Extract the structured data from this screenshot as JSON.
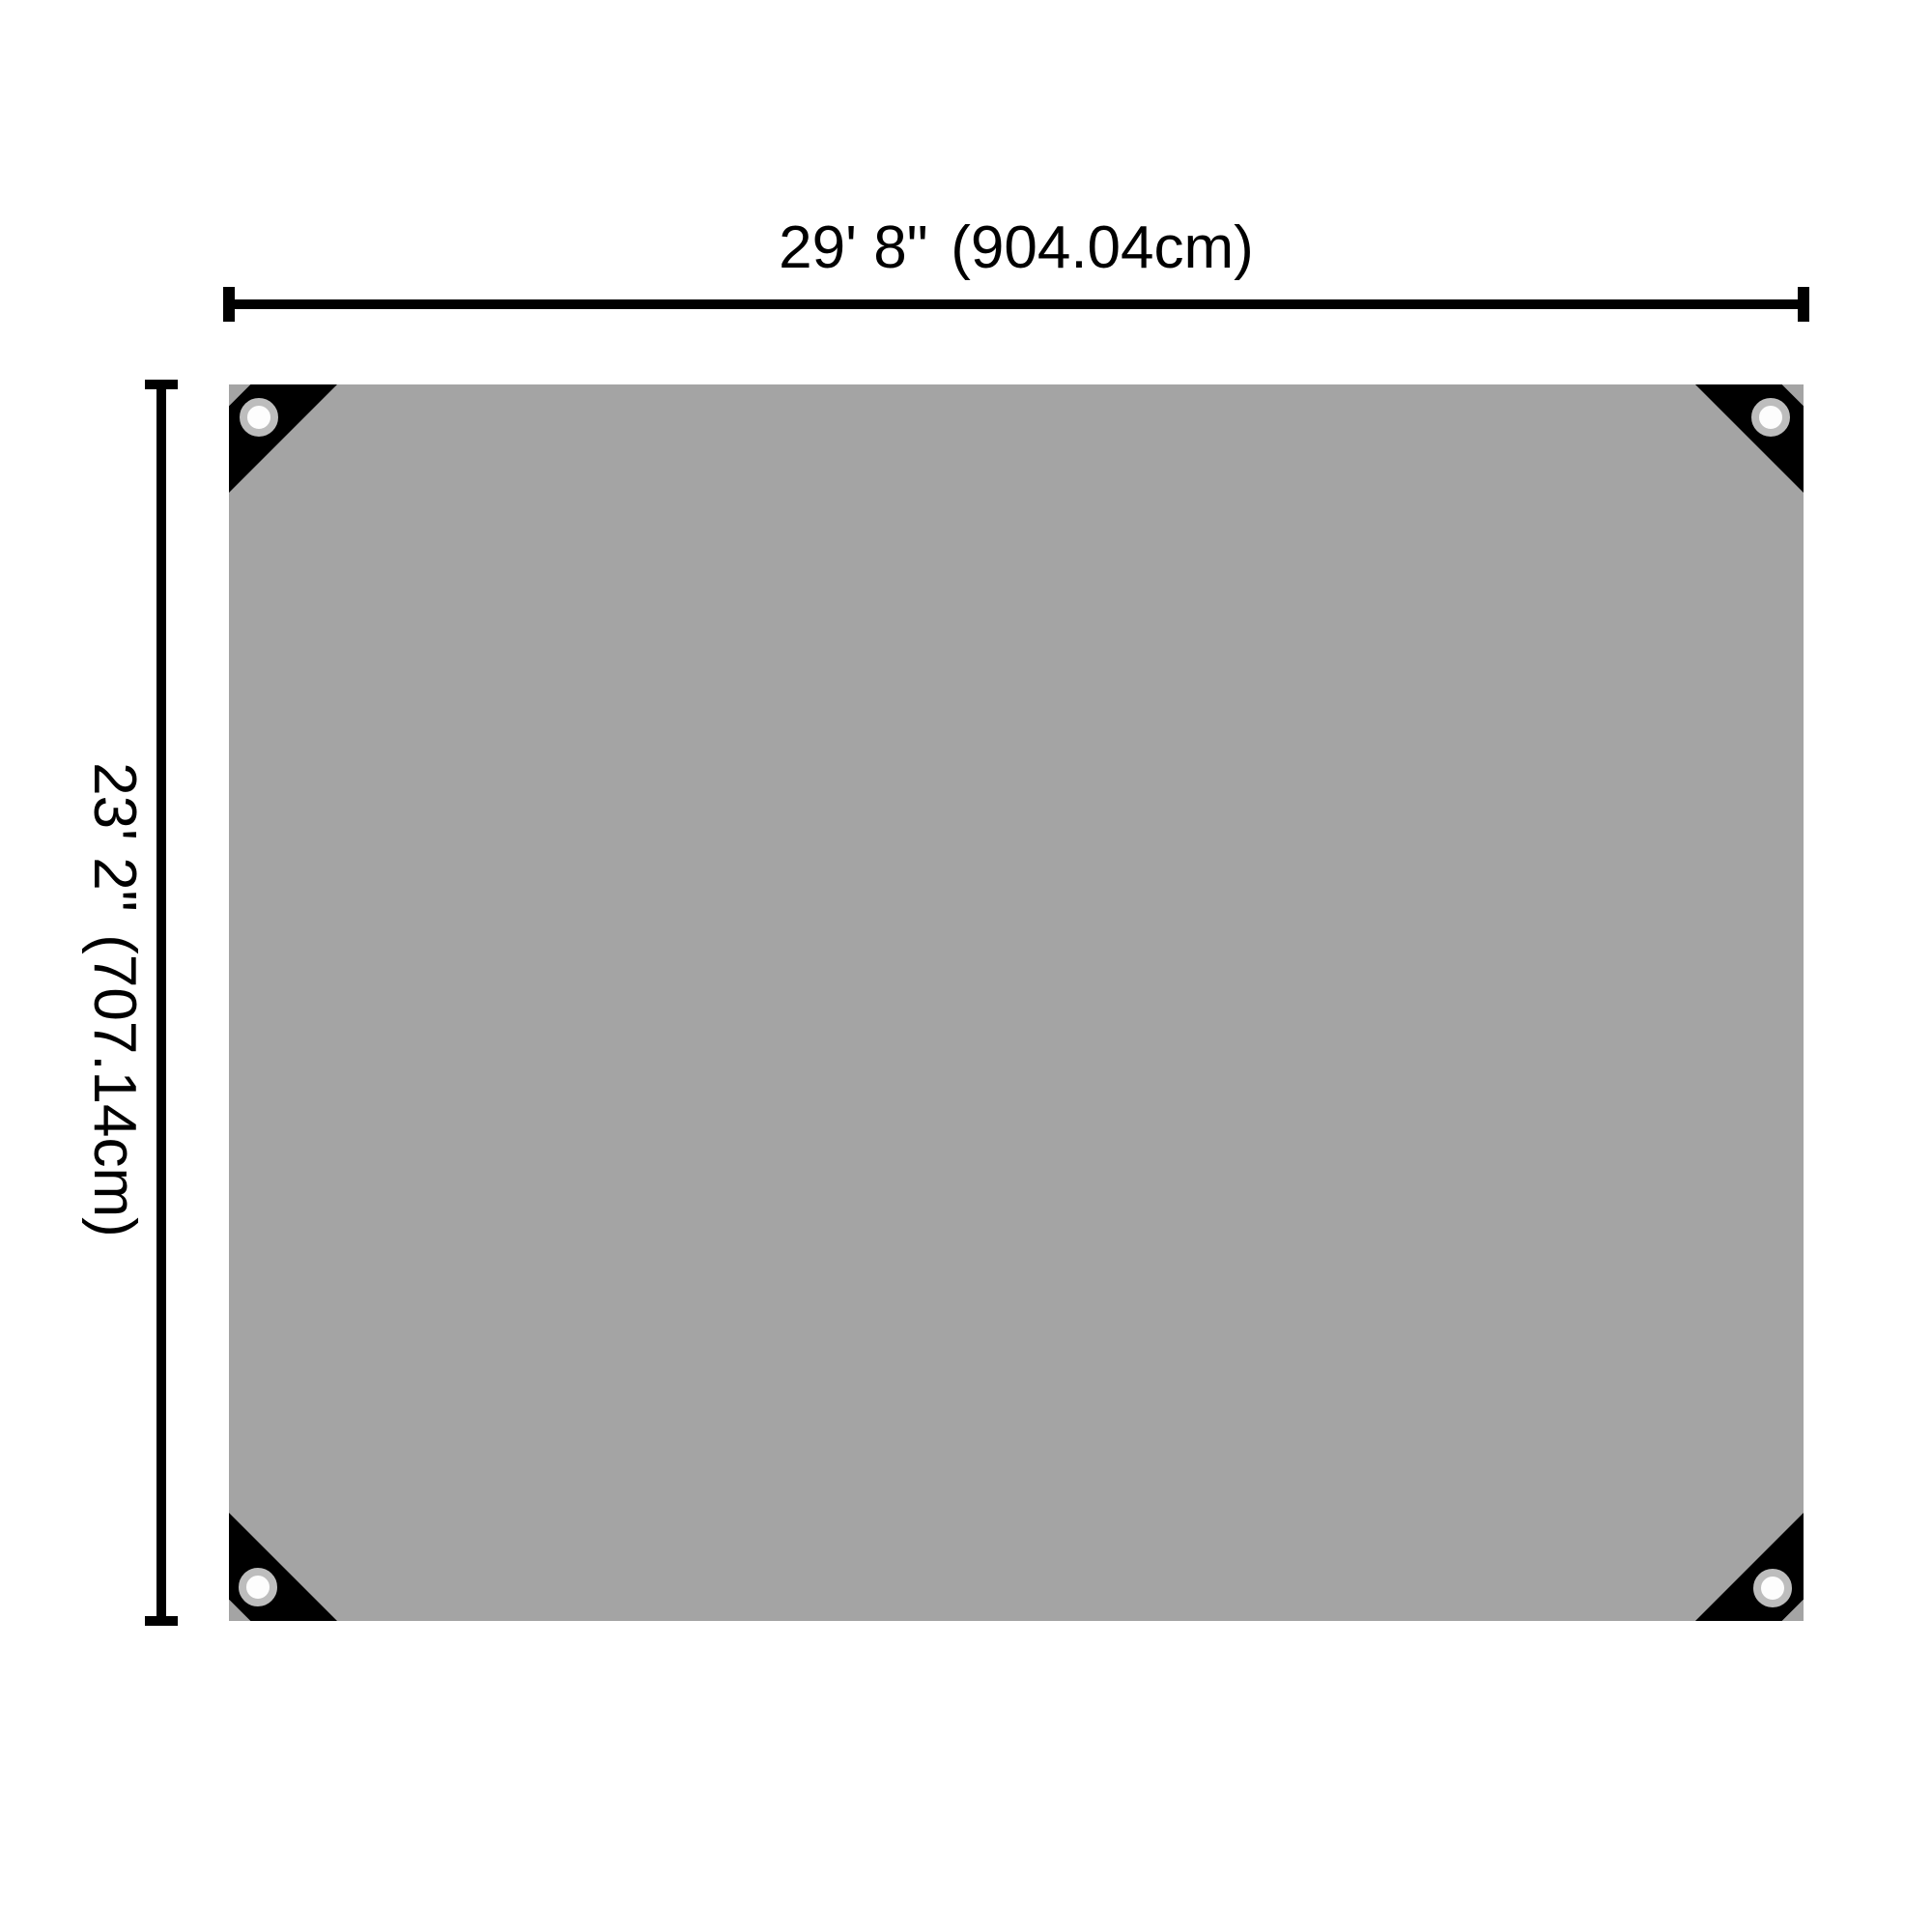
{
  "theme": {
    "bg": "#ffffff",
    "ink": "#000000",
    "tarp-fill": "#a4a4a4",
    "patch": "#000000",
    "ring": "#bdbdbd",
    "hole": "#fdfdfd"
  },
  "diagram": {
    "type": "product-dimension-diagram",
    "subject": "tarp with reinforced corners and grommets",
    "grommet_count": 4,
    "dimensions": {
      "width": {
        "imperial": "29' 8\"",
        "metric": "(904.04cm)"
      },
      "height": {
        "imperial": "23' 2\"",
        "metric": "(707.14cm)"
      }
    }
  }
}
